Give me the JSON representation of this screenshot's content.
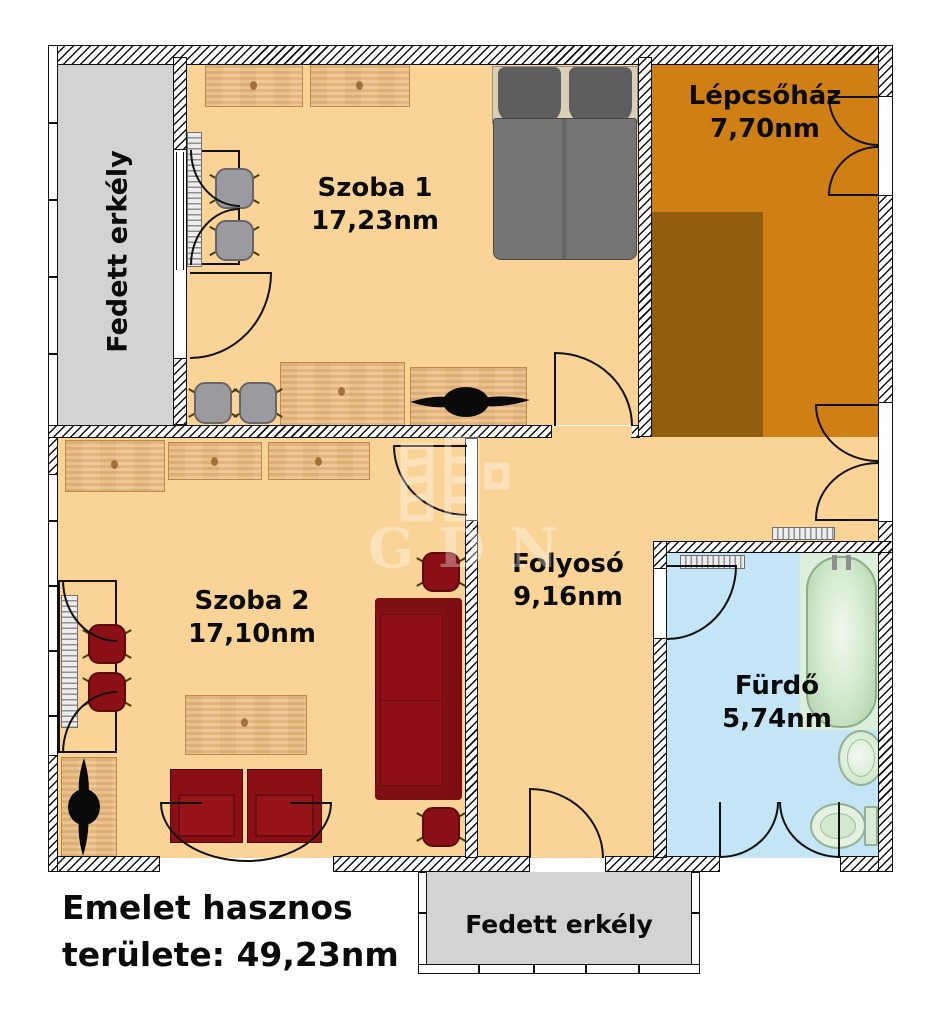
{
  "rooms": {
    "balcony_left": {
      "name": "Fedett erkély"
    },
    "szoba1": {
      "name": "Szoba 1",
      "area": "17,23nm"
    },
    "lepcsohaz": {
      "name": "Lépcsőház",
      "area": "7,70nm"
    },
    "szoba2": {
      "name": "Szoba 2",
      "area": "17,10nm"
    },
    "folyoso": {
      "name": "Folyosó",
      "area": "9,16nm"
    },
    "furdo": {
      "name": "Fürdő",
      "area": "5,74nm"
    },
    "balcony_bottom": {
      "name": "Fedett erkély"
    }
  },
  "summary": {
    "line1": "Emelet hasznos",
    "line2": "területe: 49,23nm"
  },
  "watermark": {
    "text": "GDN",
    "icon": "gdn-logo-icon"
  },
  "colors": {
    "floor": "#FAD397",
    "stair": "#CF7F14",
    "steps": "#925D0E",
    "balcony": "#D3D3D3",
    "bath": "#C4E5F6",
    "bathgreen": "#DBEFDB",
    "red": "#8B1016",
    "wood": "#EEC28B",
    "wall": "#FFFFFF",
    "line": "#111111"
  }
}
